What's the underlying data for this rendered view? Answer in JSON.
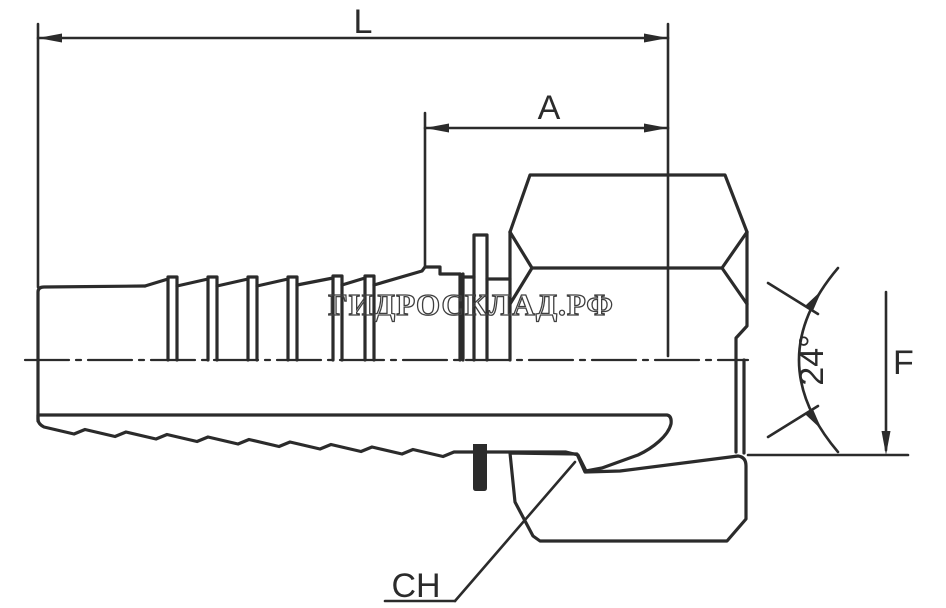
{
  "drawing": {
    "labels": {
      "overall_length": "L",
      "cutoff_length": "A",
      "cone_angle": "24°",
      "cone_diameter": "F",
      "wrench_size": "CH"
    },
    "watermark": "ГИДРОСКЛАД.РФ",
    "colors": {
      "line": "#2b2b2b",
      "background": "#ffffff",
      "watermark": "#3f3f3f"
    }
  }
}
